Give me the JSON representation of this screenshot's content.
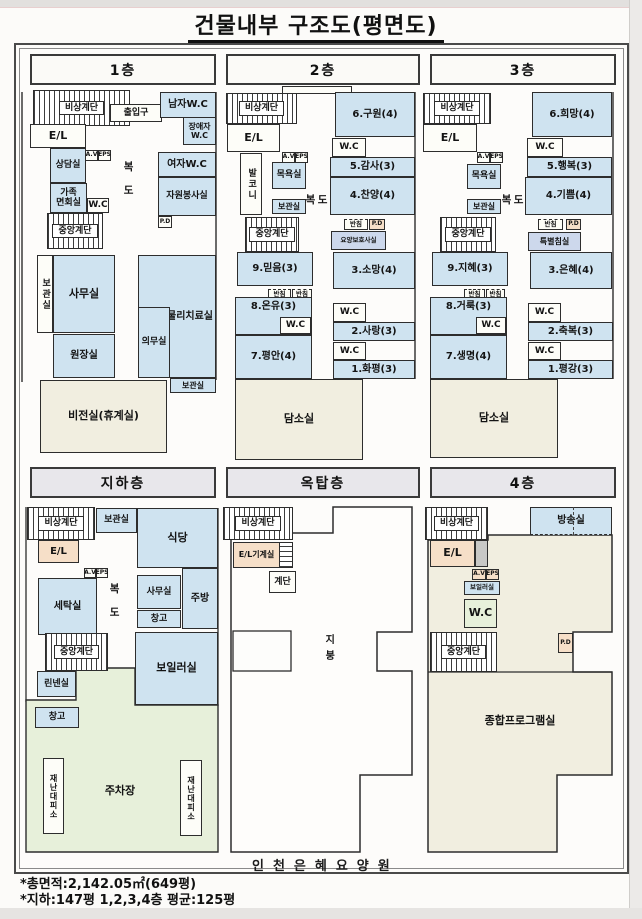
{
  "page": {
    "title": "건물내부 구조도(평면도)",
    "stamp": "인천은혜요양원",
    "footnote1": "*총면적:2,142.05㎡(649평)",
    "footnote2": "*지하:147평   1,2,3,4층 평균:125평"
  },
  "headers": {
    "f1": "1층",
    "f2": "2층",
    "f3": "3층",
    "b1": "지하층",
    "roof": "옥탑층",
    "f4": "4층"
  },
  "common": {
    "emergency_stairs": "비상계단",
    "central_stairs": "중앙계단",
    "elevator": "E/L",
    "wc": "W.C",
    "corridor": "복도",
    "storage": "보관실",
    "bath": "목욕실",
    "banchim": "반침",
    "av": "A.V",
    "eps": "EPS",
    "pd": "P.D",
    "damso": "담소실",
    "office": "사무실",
    "warehouse": "창고",
    "stairs": "계단"
  },
  "f1": {
    "entrance": "출입구",
    "men_wc": "남자W.C",
    "disabled_wc": "장애자\nW.C",
    "counsel": "상담실",
    "women_wc": "여자W.C",
    "family": "가족\n면회실",
    "volunteer": "자원봉사실",
    "director": "원장실",
    "physio": "물리치료실",
    "medical": "의무실",
    "vision": "비전실(휴계실)"
  },
  "f2": {
    "balcony": "발코니",
    "r6": "6.구원(4)",
    "r5": "5.감사(3)",
    "r4": "4.찬양(4)",
    "care": "요양보호사실",
    "r9": "9.믿음(3)",
    "r3": "3.소망(4)",
    "r8": "8.온유(3)",
    "r2": "2.사랑(3)",
    "r7": "7.평안(4)",
    "r1": "1.화평(3)"
  },
  "f3": {
    "r6": "6.희망(4)",
    "r5": "5.행복(3)",
    "r4": "4.기쁨(4)",
    "special": "특별침실",
    "r9": "9.지혜(3)",
    "r3": "3.은혜(4)",
    "r8": "8.거룩(3)",
    "r2": "2.축복(3)",
    "r7": "7.생명(4)",
    "r1": "1.평강(3)"
  },
  "b1": {
    "dining": "식당",
    "laundry": "세탁실",
    "kitchen": "주방",
    "linen": "린넨실",
    "boiler": "보일러실",
    "parking": "주차장",
    "shelter": "재난대피소"
  },
  "roof": {
    "machine_room": "E/L기계실",
    "roof_label": "지붕"
  },
  "f4": {
    "broadcast": "방송실",
    "boiler": "보일러실",
    "program": "종합프로그램실"
  },
  "colors": {
    "blue": "#cfe3f0",
    "cream": "#f1eee0",
    "green": "#e7f0da",
    "pink": "#f6dfc8",
    "lav": "#cdd8ec"
  }
}
